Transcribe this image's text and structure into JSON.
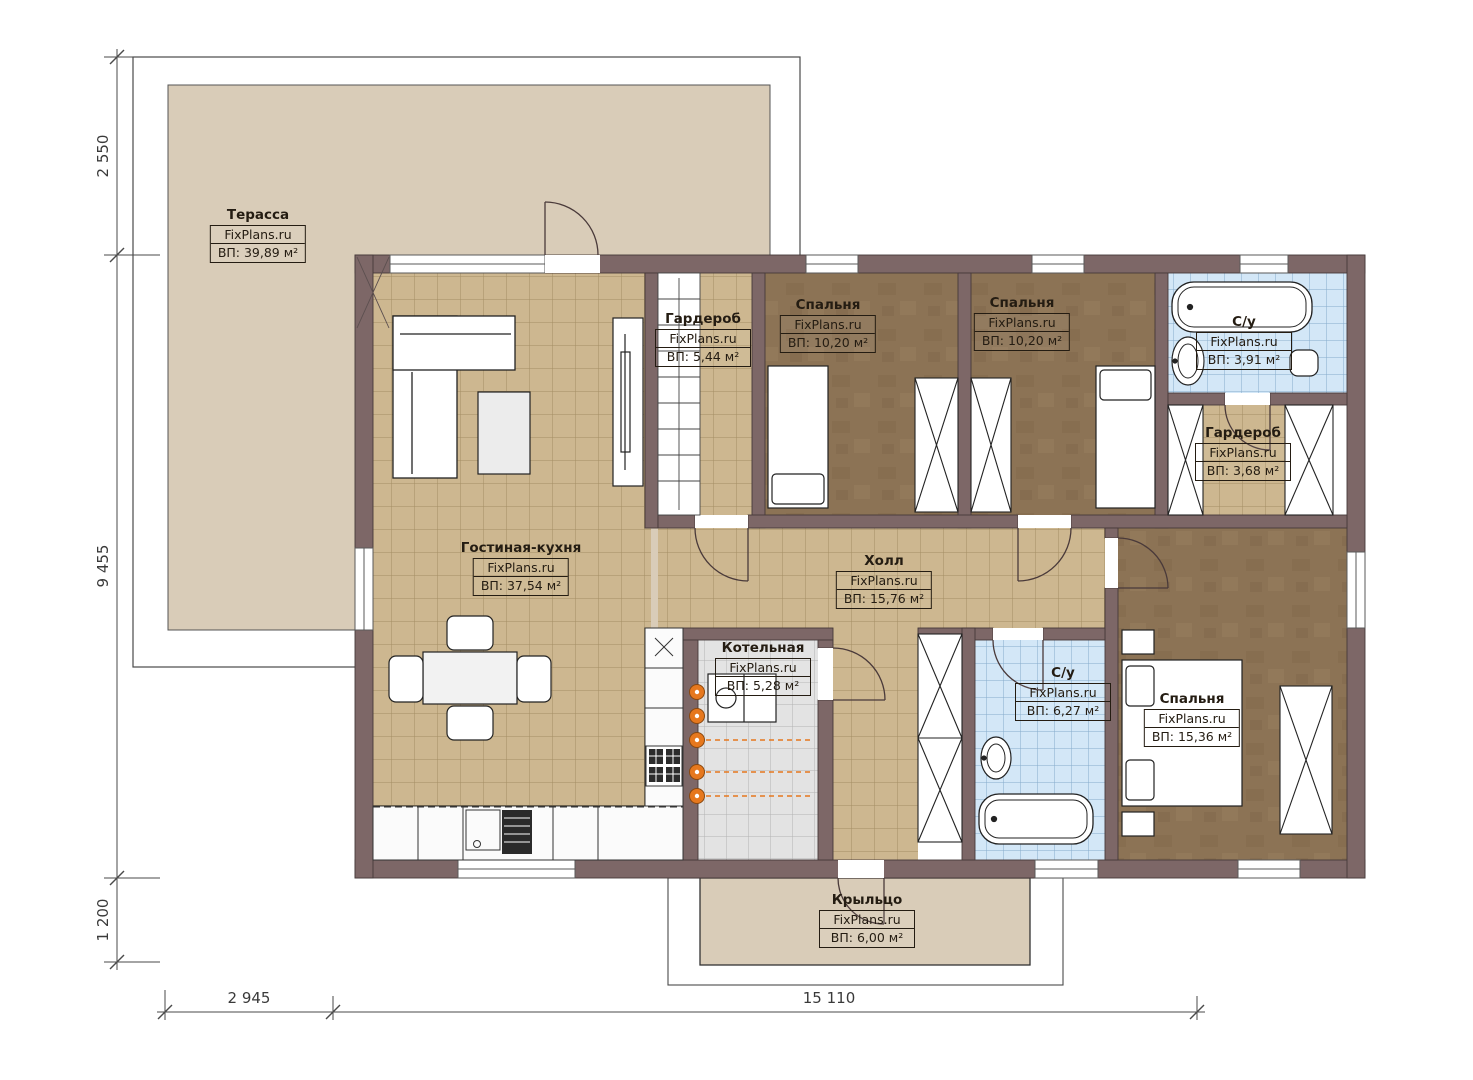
{
  "brand": "FixPlans.ru",
  "rooms": {
    "terrace": {
      "name": "Терасса",
      "area": "ВП: 39,89 м²"
    },
    "wardrobe1": {
      "name": "Гардероб",
      "area": "ВП: 5,44 м²"
    },
    "bedroom1": {
      "name": "Спальня",
      "area": "ВП: 10,20 м²"
    },
    "bedroom2": {
      "name": "Спальня",
      "area": "ВП: 10,20 м²"
    },
    "bath1": {
      "name": "С/у",
      "area": "ВП: 3,91 м²"
    },
    "wardrobe2": {
      "name": "Гардероб",
      "area": "ВП: 3,68 м²"
    },
    "living": {
      "name": "Гостиная-кухня",
      "area": "ВП: 37,54 м²"
    },
    "hall": {
      "name": "Холл",
      "area": "ВП: 15,76 м²"
    },
    "boiler": {
      "name": "Котельная",
      "area": "ВП: 5,28 м²"
    },
    "bath2": {
      "name": "С/у",
      "area": "ВП: 6,27 м²"
    },
    "bedroom3": {
      "name": "Спальня",
      "area": "ВП: 15,36 м²"
    },
    "porch": {
      "name": "Крыльцо",
      "area": "ВП: 6,00 м²"
    }
  },
  "dimensions": {
    "left_top": "2 550",
    "left_middle": "9 455",
    "left_bottom": "1 200",
    "bottom_left": "2 945",
    "bottom_right": "15 110"
  },
  "colors": {
    "wall": "#7d6767",
    "floor_tile_tan": "#cdb790",
    "floor_bedroom_brown": "#8c7355",
    "floor_tile_blue": "#d3e7f7",
    "floor_tile_gray": "#e3e3e3",
    "terrace_beige": "#d9ccb8",
    "radiator_orange": "#e6781e"
  }
}
